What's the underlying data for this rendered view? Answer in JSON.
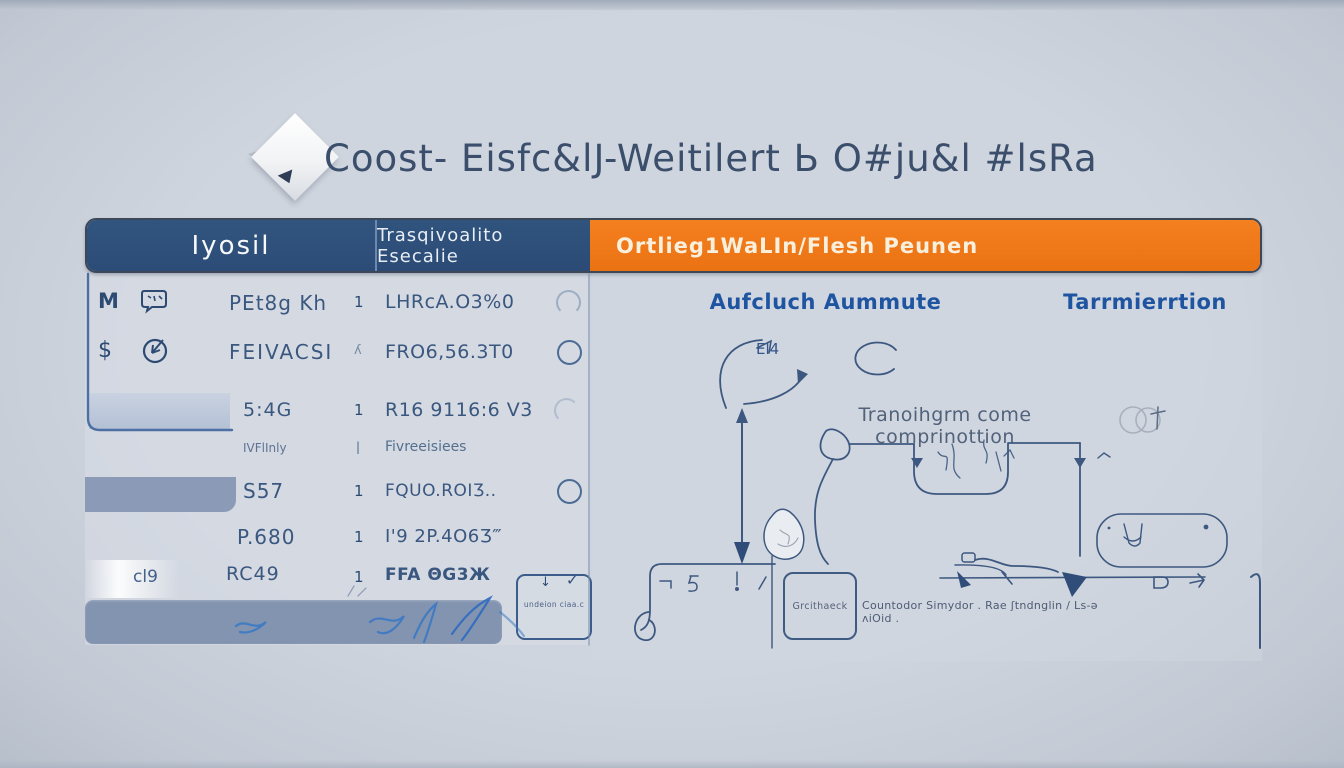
{
  "page": {
    "title": "Coost- Eisfc&lJ-Weitilert Ь O#ju&l #lsRa"
  },
  "colors": {
    "background": "#cbd2db",
    "header_blue": "#2e507b",
    "header_orange": "#ef7916",
    "accent_text_blue": "#1f55a0",
    "line_blue": "#3d5880",
    "footer_bar": "#8394b0"
  },
  "table": {
    "header": {
      "col1": "Iyosil",
      "col2": "Trasqivoalito Esecalie",
      "col3": "Ortlieg1WaLIn/Flesh Peunen"
    },
    "rows": [
      {
        "icon1": "M",
        "name": "PEt8g Kh",
        "num": "1",
        "value": "LHRcA.O3%0"
      },
      {
        "icon1": "$",
        "name": "FEIVACSI",
        "num": "ʎ",
        "value": "FRO6,56.3T0"
      },
      {
        "name": "5:4G",
        "num": "1",
        "value": "R16 9116:6 V3"
      },
      {
        "name": "IVFlInly",
        "num": "|",
        "value": "Fivreeisiees"
      },
      {
        "name": "S57",
        "num": "1",
        "value": "FQUO.ROIƷ.."
      },
      {
        "name": "P.680",
        "num": "1",
        "value": "I'9 2P.4O6Ʒ‴"
      },
      {
        "prefix": "cl9",
        "name": "RC49",
        "num": "1",
        "value": "FFA ΘG3Ж"
      }
    ],
    "note_box": {
      "arrow": "↓",
      "check": "✓",
      "text": "undeion ciaa.c"
    }
  },
  "flow": {
    "left_title": "Aufcluch Aummute",
    "right_title": "Tarrmierrtion",
    "label_el4": "El4",
    "center_text": "Tranoihgrm come comprinottion",
    "box_label": "Grcithaeck",
    "caption": "Countodor Simydor . Rae ʃtndnglin / Ls-ə ʌiOid ."
  }
}
